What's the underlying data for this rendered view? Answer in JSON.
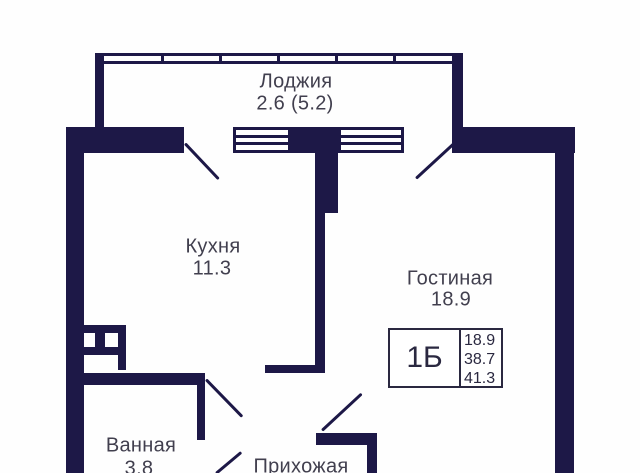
{
  "plan": {
    "rooms": {
      "loggia": {
        "name": "Лоджия",
        "area": "2.6 (5.2)"
      },
      "kitchen": {
        "name": "Кухня",
        "area": "11.3"
      },
      "living": {
        "name": "Гостиная",
        "area": "18.9"
      },
      "bathroom": {
        "name": "Ванная",
        "area": "3.8"
      },
      "hallway": {
        "name": "Прихожая"
      }
    },
    "legend": {
      "type": "1Б",
      "values": [
        "18.9",
        "38.7",
        "41.3"
      ]
    },
    "colors": {
      "wall": "#1d1847",
      "text": "#413f4e",
      "legend_border": "#2a2840",
      "background": "#fefefe"
    }
  }
}
